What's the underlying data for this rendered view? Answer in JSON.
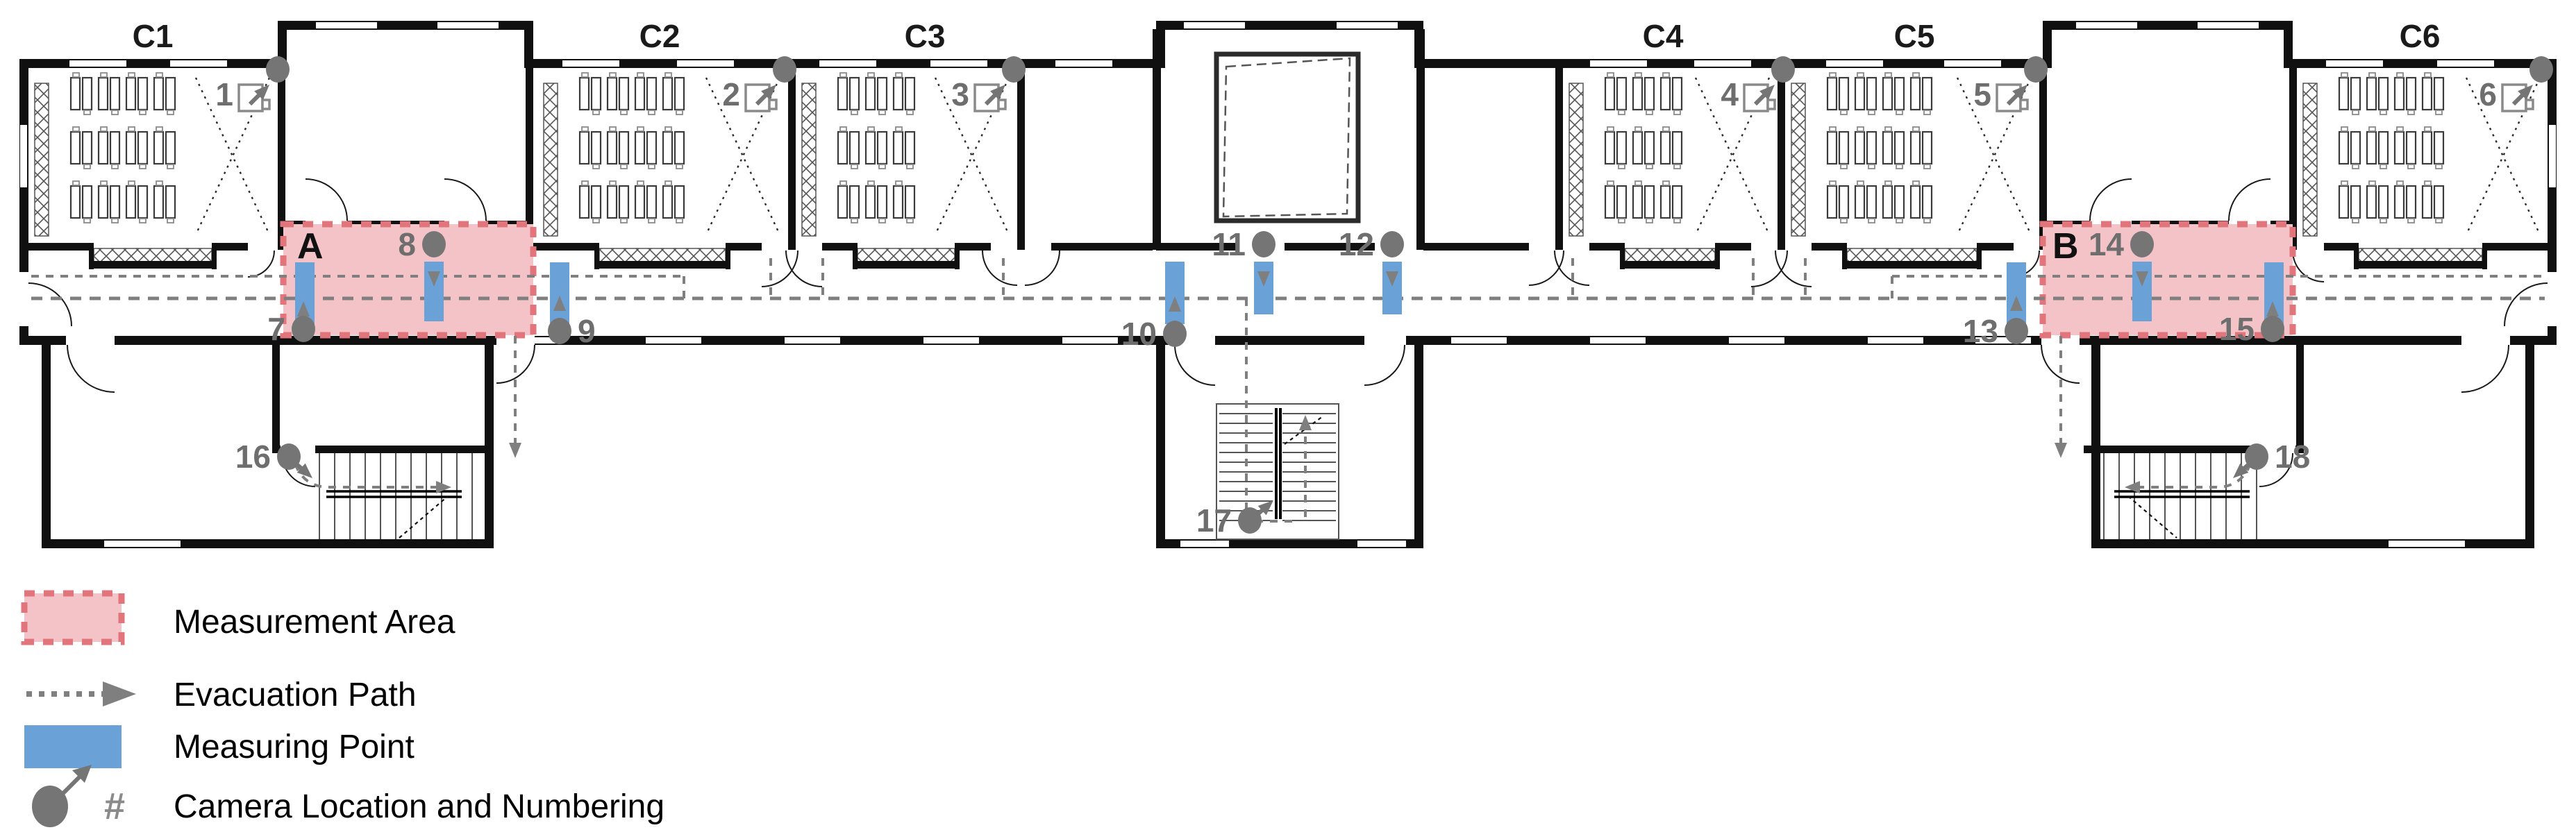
{
  "plan": {
    "classrooms": [
      {
        "label": "C1"
      },
      {
        "label": "C2"
      },
      {
        "label": "C3"
      },
      {
        "label": "C4"
      },
      {
        "label": "C5"
      },
      {
        "label": "C6"
      }
    ],
    "areas": [
      {
        "label": "A"
      },
      {
        "label": "B"
      }
    ],
    "cameras": [
      {
        "label": "1"
      },
      {
        "label": "2"
      },
      {
        "label": "3"
      },
      {
        "label": "4"
      },
      {
        "label": "5"
      },
      {
        "label": "6"
      },
      {
        "label": "7"
      },
      {
        "label": "8"
      },
      {
        "label": "9"
      },
      {
        "label": "10"
      },
      {
        "label": "11"
      },
      {
        "label": "12"
      },
      {
        "label": "13"
      },
      {
        "label": "14"
      },
      {
        "label": "15"
      },
      {
        "label": "16"
      },
      {
        "label": "17"
      },
      {
        "label": "18"
      }
    ]
  },
  "legend": {
    "camera_symbol": "#",
    "items": [
      {
        "label": "Measurement Area"
      },
      {
        "label": "Evacuation Path"
      },
      {
        "label": "Measuring Point"
      },
      {
        "label": "Camera Location and Numbering"
      }
    ]
  },
  "colors": {
    "measurement_fill": "#f4c3c7",
    "measurement_border": "#e2757b",
    "measuring_point_blue": "#6aa2d8",
    "camera_gray": "#757575",
    "path_gray": "#7f7f7f",
    "wall": "#101010"
  }
}
